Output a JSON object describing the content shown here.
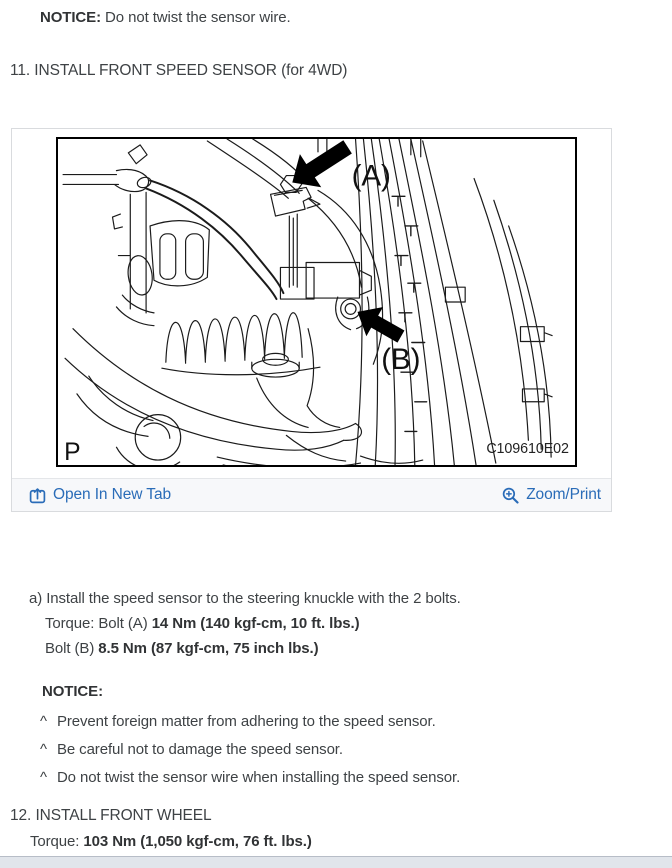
{
  "colors": {
    "link_blue": "#2a6cb8",
    "body_text": "#3e4245",
    "bold_text": "#313335",
    "toolbar_bg": "#f7f8fa",
    "card_border": "#d9dbde",
    "diagram_frame": "#000000",
    "bottom_bar": "#e1e5eb"
  },
  "top_notice": {
    "label": "NOTICE:",
    "text": "Do not twist the sensor wire."
  },
  "step_11": {
    "heading": "11. INSTALL FRONT SPEED SENSOR (for 4WD)"
  },
  "figure": {
    "callout_a": "(A)",
    "callout_b": "(B)",
    "plate_letter": "P",
    "code": "C109610E02",
    "toolbar": {
      "open_label": "Open In New Tab",
      "zoom_label": "Zoom/Print"
    },
    "icons": {
      "open_icon": "open-in-new-tab-icon",
      "zoom_icon": "zoom-in-magnifier-icon"
    }
  },
  "instructions": {
    "step_a": "a) Install the speed sensor to the steering knuckle with the 2 bolts.",
    "torque_a": {
      "prefix": "Torque: Bolt (A) ",
      "value": "14 Nm (140 kgf-cm, 10 ft. lbs.)"
    },
    "torque_b": {
      "prefix": "Bolt (B) ",
      "value": "8.5 Nm (87 kgf-cm, 75 inch lbs.)"
    },
    "notice": {
      "label": "NOTICE:",
      "bullet": "^",
      "items": [
        "Prevent foreign matter from adhering to the speed sensor.",
        "Be careful not to damage the speed sensor.",
        "Do not twist the sensor wire when installing the speed sensor."
      ]
    }
  },
  "step_12": {
    "heading": "12. INSTALL FRONT WHEEL",
    "torque": {
      "prefix": "Torque: ",
      "value": "103 Nm (1,050 kgf-cm, 76 ft. lbs.)"
    }
  }
}
